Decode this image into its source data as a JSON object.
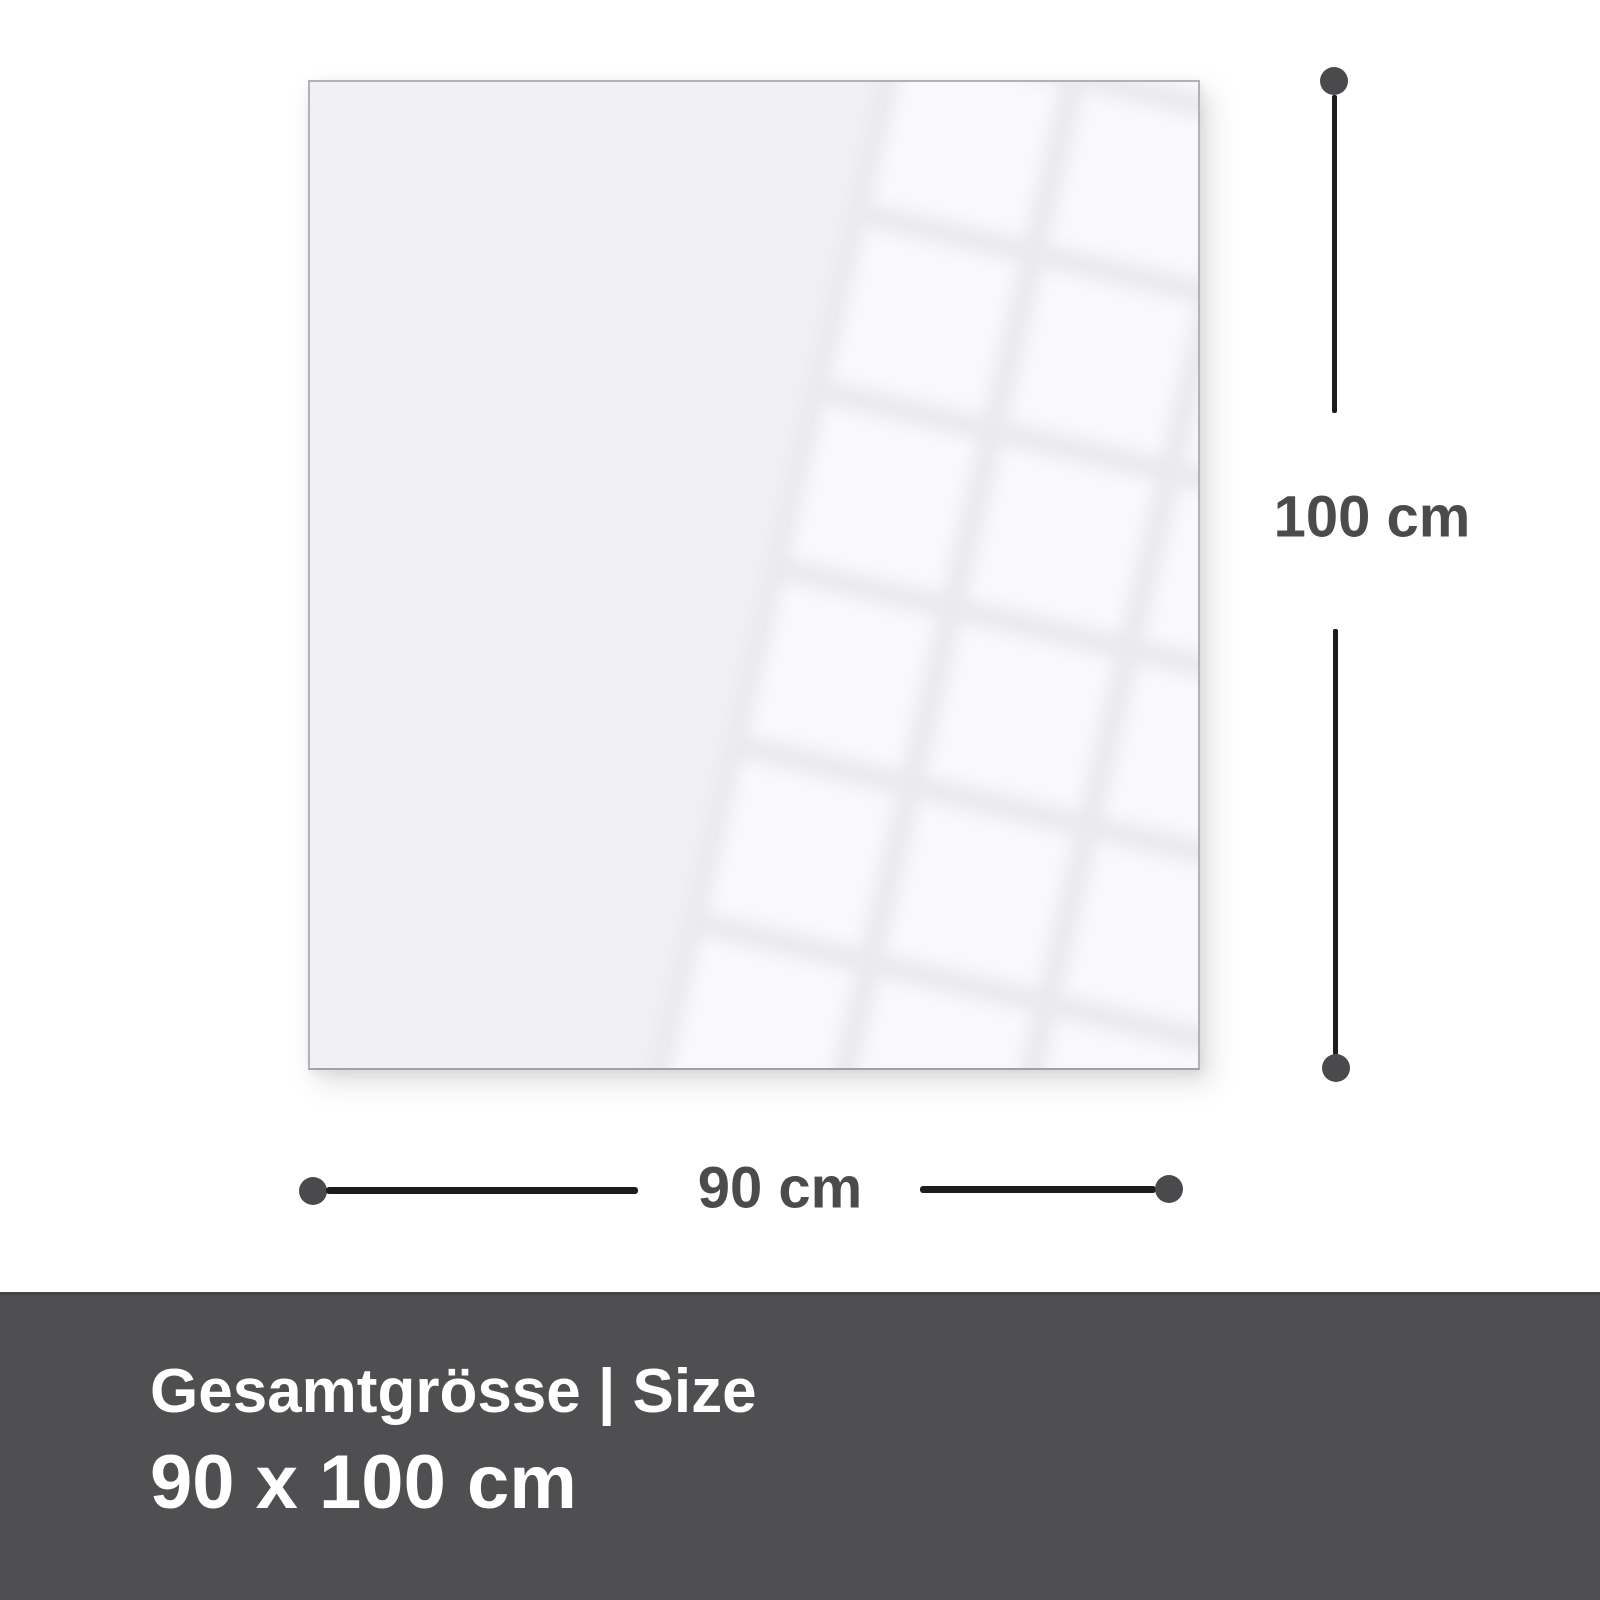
{
  "diagram": {
    "type": "product-size-diagram",
    "dimensions": {
      "height_label": "100 cm",
      "width_label": "90 cm"
    }
  },
  "footer": {
    "title": "Gesamtgrösse | Size",
    "size": "90 x 100 cm"
  },
  "colors": {
    "footer_bg": "#4f4f51",
    "footer_text": "#ffffff",
    "label_text": "#4b4b4d",
    "line": "#1c1c1e",
    "endpoint_dot": "#4a4a4c",
    "panel_fill": "#f1f1f3",
    "panel_border": "#b0b2b5"
  }
}
